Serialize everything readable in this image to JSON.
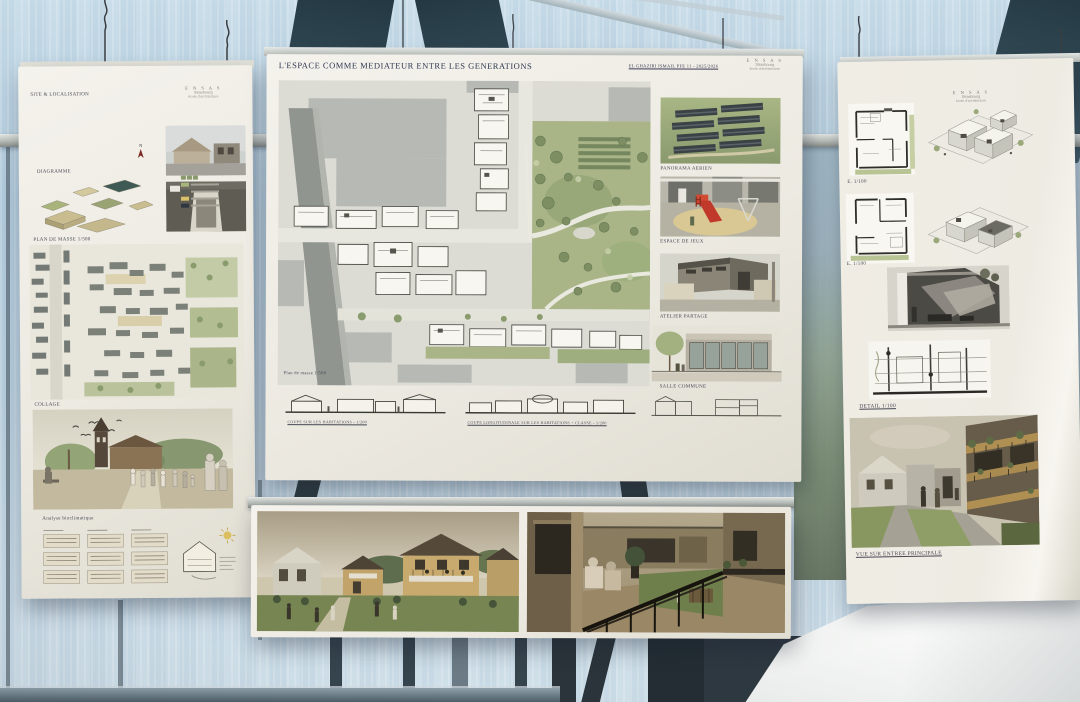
{
  "palette": {
    "glass_blue": "#aec9db",
    "glass_light": "#cfe1ec",
    "structure_dark": "#2e434e",
    "rail_gray": "#c6cbc7",
    "paper_white": "#f0ede5",
    "plan_green": "#9fae7e",
    "roof_dark": "#3e4a4e",
    "render_sepia": "#b79d72",
    "slide_red": "#c0392b",
    "table_white": "#f3f4f3"
  },
  "school_logo": {
    "glyphs": "E N S A S",
    "city": "Strasbourg",
    "school": "école d'architecture"
  },
  "left_poster": {
    "label_site": "SITE & LOCALISATION",
    "label_diagram": "DIAGRAMME",
    "label_plan": "PLAN DE MASSE 1/500",
    "label_collage": "COLLAGE",
    "label_analysis": "Analyse bioclimatique",
    "north_letter": "N"
  },
  "center_poster": {
    "title": "L'ESPACE COMME MEDIATEUR ENTRE LES GENERATIONS",
    "author_line": "EL GHAZIRI ISMAIL PFE 11 - 2025/2026",
    "plan_caption": "Plan de masse 1/500",
    "caption_aerial": "PANORAMA AERIEN",
    "caption_playground": "ESPACE DE JEUX",
    "caption_workshop": "ATELIER PARTAGE",
    "caption_common": "SALLE COMMUNE",
    "section_caption_left": "COUPE SUR LES HABITATIONS - 1/200",
    "section_caption_right": "COUPE LONGITUDINALE SUR LES HABITATIONS + CLASSE - 1/200",
    "north_letter": "N"
  },
  "right_poster": {
    "label_plan1": "E. 1/100",
    "label_plan2": "E. 1/100",
    "label_detail": "DETAIL 1/100",
    "caption_view": "VUE SUR ENTREE PRINCIPALE"
  }
}
